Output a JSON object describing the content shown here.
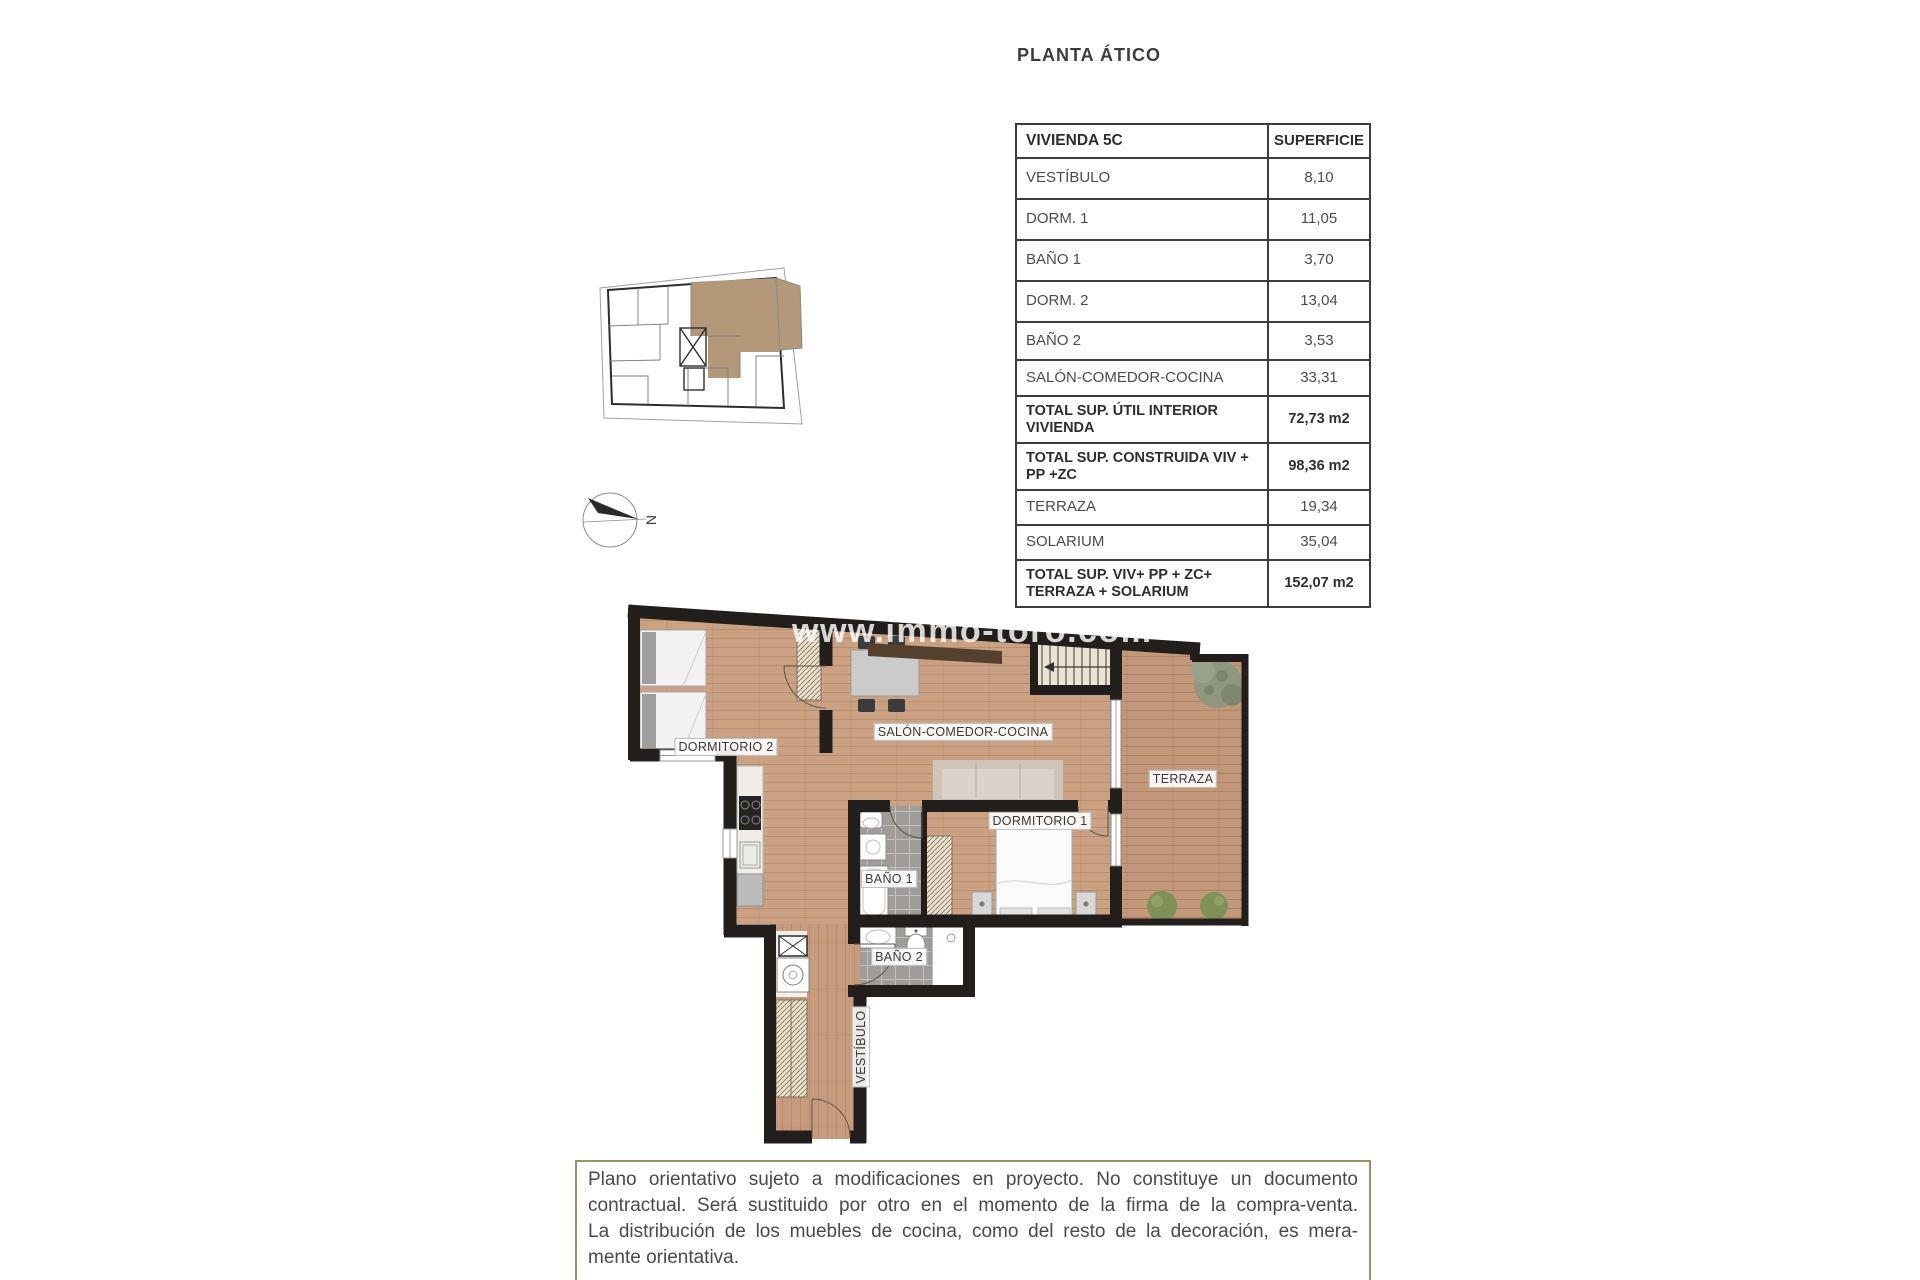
{
  "page": {
    "title": "PLANTA ÁTICO",
    "watermark": "www.immo-toro.com"
  },
  "table": {
    "header": {
      "unit": "VIVIENDA 5C",
      "area": "SUPERFICIE"
    },
    "rows": [
      {
        "label": "VESTÍBULO",
        "value": "8,10",
        "bold": false
      },
      {
        "label": "DORM. 1",
        "value": "11,05",
        "bold": false
      },
      {
        "label": "BAÑO 1",
        "value": "3,70",
        "bold": false
      },
      {
        "label": "DORM. 2",
        "value": "13,04",
        "bold": false
      },
      {
        "label": "BAÑO 2",
        "value": "3,53",
        "bold": false
      },
      {
        "label": "SALÓN-COMEDOR-COCINA",
        "value": "33,31",
        "bold": false
      },
      {
        "label": "TOTAL SUP. ÚTIL INTERIOR VIVIENDA",
        "value": "72,73 m2",
        "bold": true
      },
      {
        "label": "TOTAL SUP. CONSTRUIDA VIV + PP +ZC",
        "value": "98,36 m2",
        "bold": true
      },
      {
        "label": "TERRAZA",
        "value": "19,34",
        "bold": false
      },
      {
        "label": "SOLARIUM",
        "value": "35,04",
        "bold": false
      },
      {
        "label": "TOTAL SUP. VIV+ PP + ZC+ TERRAZA + SOLARIUM",
        "value": "152,07 m2",
        "bold": true
      }
    ]
  },
  "plan": {
    "labels": {
      "dormitorio2": "DORMITORIO 2",
      "salon": "SALÓN-COMEDOR-COCINA",
      "terraza": "TERRAZA",
      "dormitorio1": "DORMITORIO 1",
      "bano1": "BAÑO 1",
      "bano2": "BAÑO 2",
      "vestibulo": "VESTÍBULO"
    },
    "compass_north": "N"
  },
  "disclaimer": {
    "lines": [
      "Plano orientativo sujeto a modificaciones en proyecto. No constituye un documento",
      "contractual. Será sustituido por otro en el momento de la firma de la compra-venta.",
      "La distribución de los muebles de cocina, como del resto de la decoración, es mera-",
      "mente orientativa."
    ]
  },
  "colors": {
    "wall": "#211e1c",
    "wood_floor": "#c99f7e",
    "terrace_wood": "#c2977a",
    "unit_highlight": "#b3987a",
    "bath_tile": "#9f9c99",
    "disclaimer_border": "#9d9165"
  }
}
